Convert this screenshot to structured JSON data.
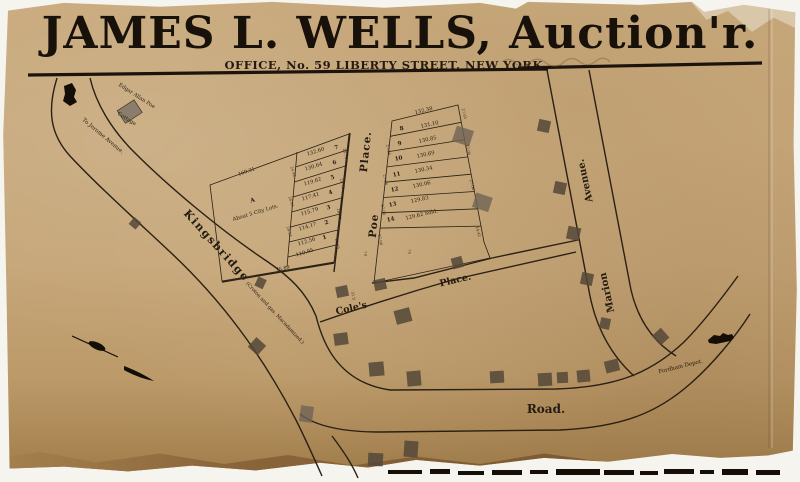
{
  "header": {
    "title": "JAMES L. WELLS, Auction'r.",
    "subtitle": "OFFICE, No. 59 LIBERTY STREET, NEW YORK."
  },
  "colors": {
    "paper": "#c3a274",
    "ink": "#241b10",
    "line": "#2a2014"
  },
  "landmarks": {
    "poe_cottage_1": "Edgar Allan Poe",
    "poe_cottage_2": "Cottage",
    "to_jerome": "To Jerome Avenue.",
    "fordham_depot": "Fordham Depot."
  },
  "streets": {
    "kingsbridge": "Kingsbridge",
    "kingsbridge_note": "(Croton and gas.  Macadamized.)",
    "poe": "Poe",
    "poe_place": "Place.",
    "coles": "Cole's",
    "coles_place": "Place.",
    "marion": "Marion",
    "marion_avenue": "Avenue.",
    "road": "Road."
  },
  "parcel_a": {
    "label": "A",
    "desc": "About 5 City Lots.",
    "north_dim": "160.31",
    "south_dim": "75.89"
  },
  "west_block": {
    "lots": [
      {
        "num": "7",
        "len": "132.60"
      },
      {
        "num": "6",
        "len": "130.64"
      },
      {
        "num": "5",
        "len": "119.62"
      },
      {
        "num": "4",
        "len": "117.41"
      },
      {
        "num": "3",
        "len": "115.79"
      },
      {
        "num": "2",
        "len": "114.17"
      },
      {
        "num": "1",
        "len": "112.56"
      }
    ],
    "south_line": "110.95",
    "west_dims": [
      "26.42",
      "26.41",
      "26.34"
    ],
    "east_dims": [
      "26.75",
      "26.75",
      "26.76",
      "26.75"
    ]
  },
  "east_block": {
    "north_line": "132.38",
    "lots": [
      {
        "num": "8",
        "len": "131.10"
      },
      {
        "num": "9",
        "len": "130.85"
      },
      {
        "num": "10",
        "len": "130.69"
      },
      {
        "num": "11",
        "len": "130.34"
      },
      {
        "num": "12",
        "len": "130.06"
      },
      {
        "num": "13",
        "len": "129.83"
      },
      {
        "num": "14",
        "len": "129.62 Sold."
      }
    ],
    "west_dims": [
      "27.06",
      "27.06",
      "27.06",
      "27.06"
    ],
    "east_dims": [
      "27.65",
      "27.06",
      "27.06",
      "24.42"
    ]
  },
  "dims": {
    "poe_end_w": "70",
    "poe_end_e": "75",
    "coles_width": "31.9"
  }
}
